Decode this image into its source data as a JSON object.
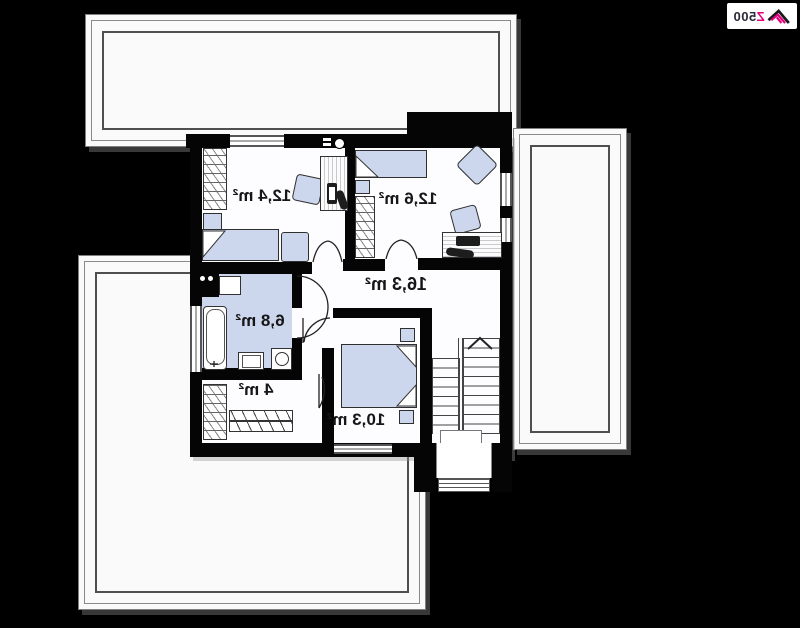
{
  "logo": {
    "brand_prefix": "Z",
    "brand_suffix": "500"
  },
  "plan": {
    "rooms": [
      {
        "name": "bedroom-top-left",
        "area_label": "12,4 m²"
      },
      {
        "name": "bedroom-top-right",
        "area_label": "12,6 m²"
      },
      {
        "name": "hall",
        "area_label": "16,3 m²"
      },
      {
        "name": "bathroom",
        "area_label": "6,8 m²"
      },
      {
        "name": "closet",
        "area_label": "4 m²"
      },
      {
        "name": "bedroom-bottom",
        "area_label": "10,3 m²"
      }
    ]
  },
  "colors": {
    "background": "#000000",
    "wall": "#050505",
    "floor": "#fdfdff",
    "furniture_fill": "#ccd7ee",
    "bathroom_floor": "#ccd7ee",
    "logo_accent": "#e6007e",
    "logo_text": "#2a2a3a"
  }
}
